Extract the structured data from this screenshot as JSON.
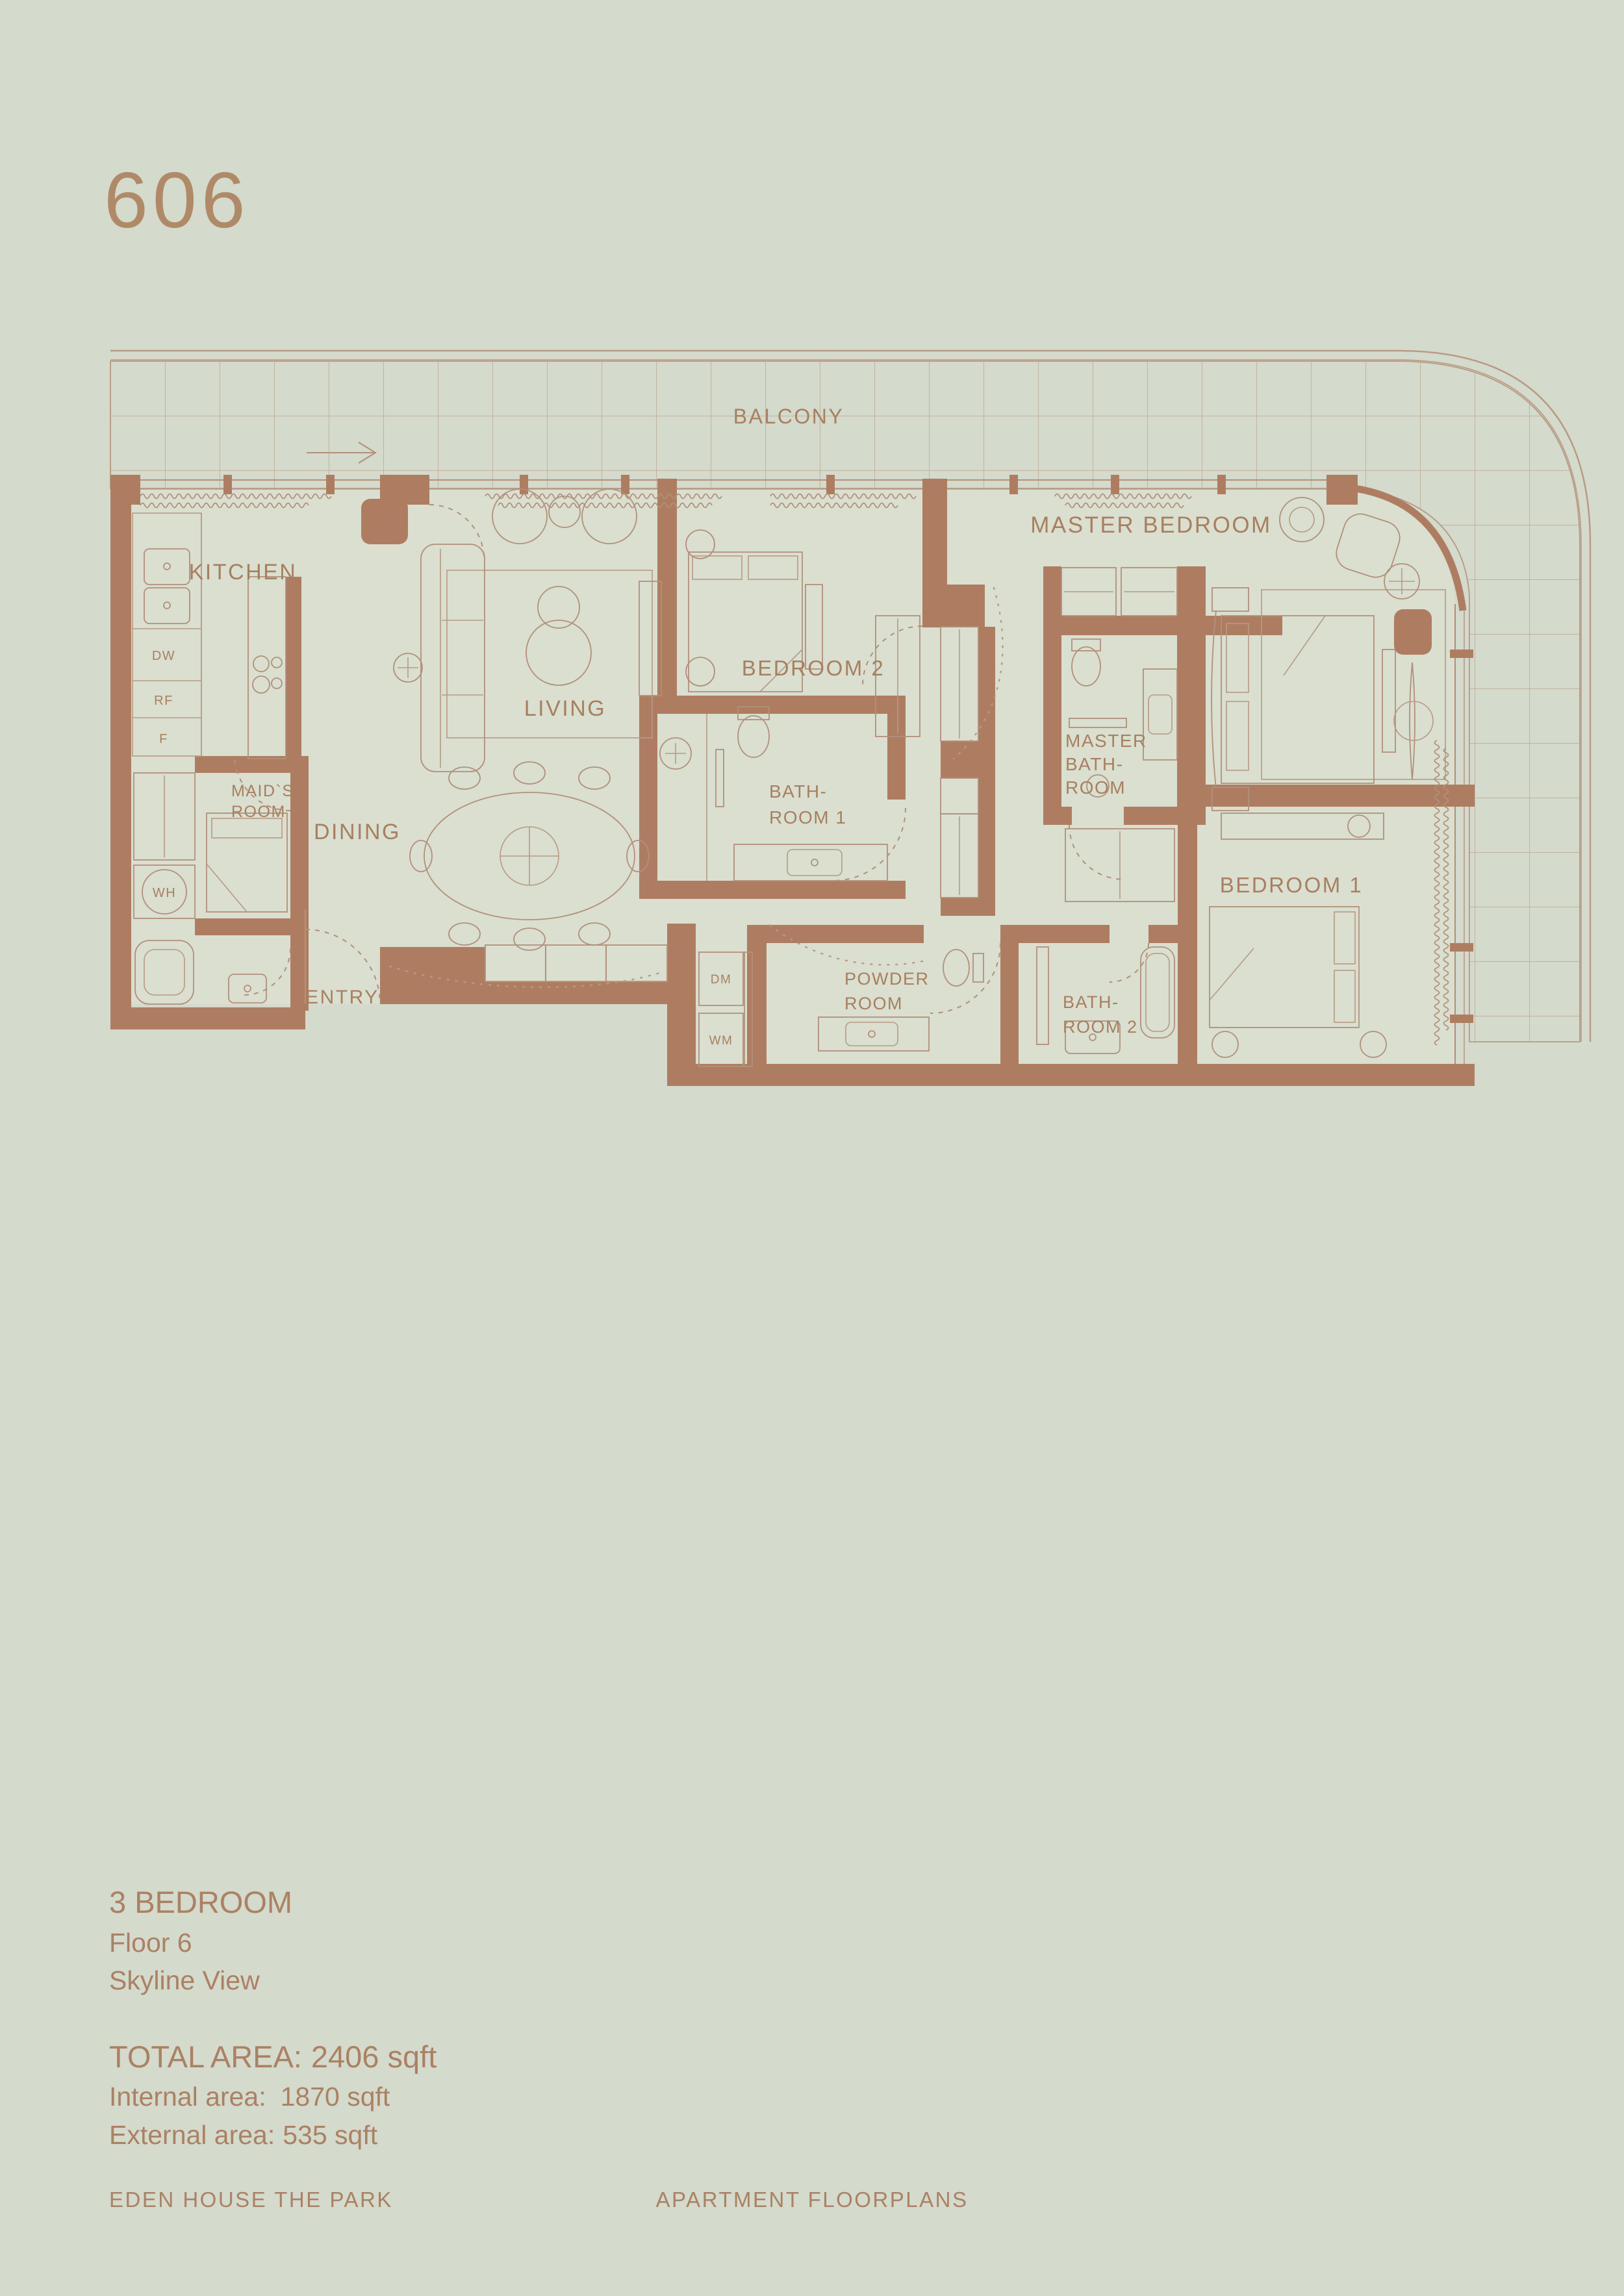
{
  "colors": {
    "background": "#d4dacc",
    "floor": "#dadfd0",
    "wall": "#ae7d61",
    "accent_text": "#a87f5f",
    "title_text": "#b08a68",
    "drawing_line": "#b2907a"
  },
  "unit": {
    "number": "606"
  },
  "floorplan": {
    "balcony_label": "BALCONY",
    "labels": {
      "kitchen": "KITCHEN",
      "living": "LIVING",
      "dining": "DINING",
      "entry": "ENTRY",
      "balcony": "BALCONY",
      "bedroom2": "BEDROOM 2",
      "bedroom1": "BEDROOM 1",
      "master_bedroom": "MASTER BEDROOM",
      "maids_line1": "MAID`S",
      "maids_line2": "ROOM",
      "bath1_line1": "BATH-",
      "bath1_line2": "ROOM 1",
      "master_bath_line1": "MASTER",
      "master_bath_line2": "BATH-",
      "master_bath_line3": "ROOM",
      "powder_line1": "POWDER",
      "powder_line2": "ROOM",
      "bath2_line1": "BATH-",
      "bath2_line2": "ROOM 2"
    },
    "appliances": {
      "dw": "DW",
      "rf": "RF",
      "f": "F",
      "wh": "WH",
      "dm": "DM",
      "wm": "WM"
    }
  },
  "unit_details": {
    "bedrooms": "3 BEDROOM",
    "floor": "Floor 6",
    "view": "Skyline View",
    "total_area_label": "TOTAL AREA:",
    "total_area_value": "2406 sqft",
    "internal_area_label": "Internal area:",
    "internal_area_value": "1870 sqft",
    "external_area_label": "External area:",
    "external_area_value": "535 sqft"
  },
  "footer": {
    "project_name": "EDEN HOUSE THE PARK",
    "document_name": "APARTMENT FLOORPLANS"
  }
}
